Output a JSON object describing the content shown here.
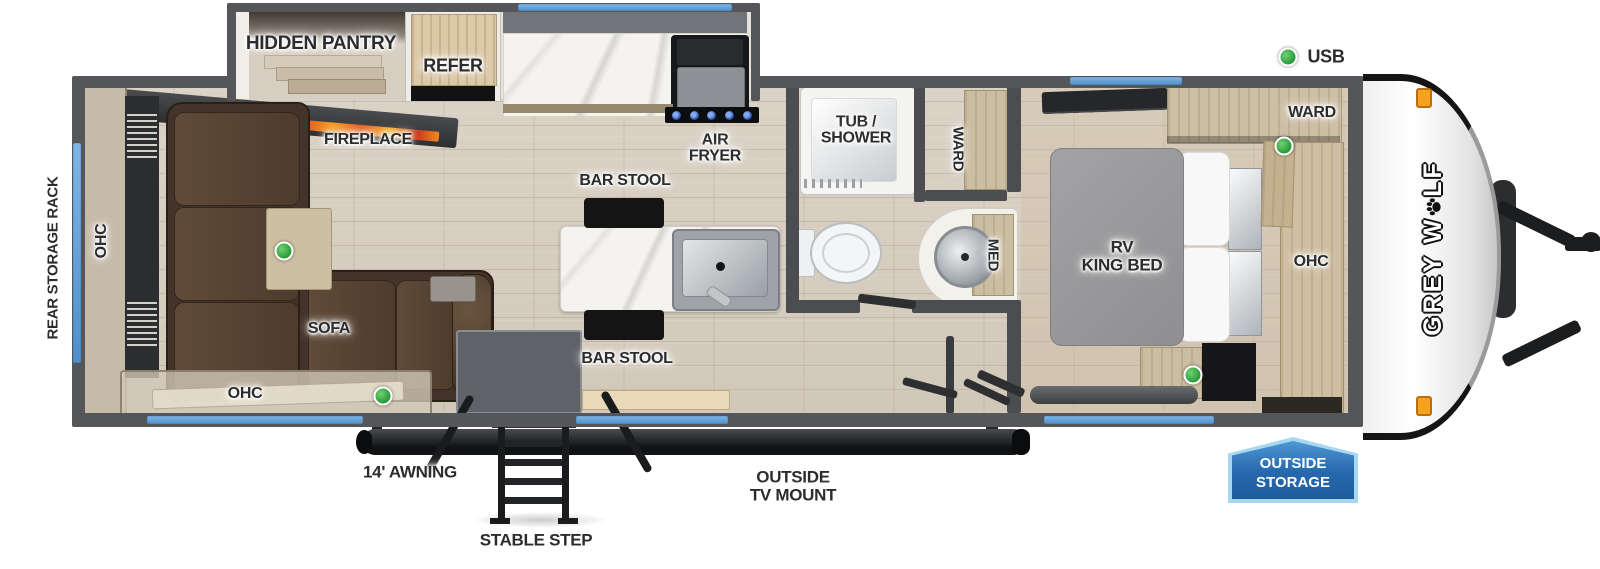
{
  "title": "Grey Wolf Travel Trailer Floorplan",
  "logo": {
    "prefix": "GREY W",
    "suffix": "LF"
  },
  "badge": {
    "line1": "OUTSIDE",
    "line2": "STORAGE"
  },
  "legend": {
    "usb_label": "USB"
  },
  "colors": {
    "wall": "#55565a",
    "window": "#62a0d8",
    "usb_green": "#3cb54a",
    "badge_blue": "#2f76b5",
    "marker_orange": "#f6a21d"
  },
  "labels": [
    {
      "name": "label-hidden-pantry",
      "text": "HIDDEN PANTRY",
      "x": 321,
      "y": 44,
      "size": 19,
      "rot": 0
    },
    {
      "name": "label-refer",
      "text": "REFER",
      "x": 453,
      "y": 66,
      "size": 18,
      "rot": 0
    },
    {
      "name": "label-fireplace",
      "text": "FIREPLACE",
      "x": 368,
      "y": 140,
      "size": 16,
      "rot": 0
    },
    {
      "name": "label-air-fryer",
      "text": "AIR\nFRYER",
      "x": 715,
      "y": 149,
      "size": 16,
      "rot": 0
    },
    {
      "name": "label-bar-stool-top",
      "text": "BAR STOOL",
      "x": 625,
      "y": 181,
      "size": 16,
      "rot": 0
    },
    {
      "name": "label-bar-stool-bottom",
      "text": "BAR STOOL",
      "x": 627,
      "y": 359,
      "size": 16,
      "rot": 0
    },
    {
      "name": "label-tub-shower",
      "text": "TUB /\nSHOWER",
      "x": 856,
      "y": 131,
      "size": 16,
      "rot": 0
    },
    {
      "name": "label-ward-bath",
      "text": "WARD",
      "x": 958,
      "y": 149,
      "size": 15,
      "rot": 90
    },
    {
      "name": "label-med",
      "text": "MED",
      "x": 993,
      "y": 255,
      "size": 15,
      "rot": 90
    },
    {
      "name": "label-rv-king-bed",
      "text": "RV\nKING BED",
      "x": 1122,
      "y": 256,
      "size": 17,
      "rot": 0
    },
    {
      "name": "label-ward-bedroom",
      "text": "WARD",
      "x": 1312,
      "y": 113,
      "size": 16,
      "rot": 0
    },
    {
      "name": "label-ohc-bedroom",
      "text": "OHC",
      "x": 1311,
      "y": 262,
      "size": 16,
      "rot": 0
    },
    {
      "name": "label-usb-legend",
      "text": "USB",
      "x": 1326,
      "y": 57,
      "size": 18,
      "rot": 0
    },
    {
      "name": "label-rear-storage-rack",
      "text": "REAR STORAGE RACK",
      "x": 53,
      "y": 258,
      "size": 15,
      "rot": -90
    },
    {
      "name": "label-ohc-left",
      "text": "OHC",
      "x": 102,
      "y": 241,
      "size": 16,
      "rot": -90
    },
    {
      "name": "label-ohc-bottom",
      "text": "OHC",
      "x": 245,
      "y": 394,
      "size": 16,
      "rot": 0
    },
    {
      "name": "label-sofa",
      "text": "SOFA",
      "x": 329,
      "y": 329,
      "size": 16,
      "rot": 0
    },
    {
      "name": "label-awning",
      "text": "14' AWNING",
      "x": 410,
      "y": 472,
      "size": 17,
      "rot": 0
    },
    {
      "name": "label-stable-step",
      "text": "STABLE STEP",
      "x": 536,
      "y": 540,
      "size": 17,
      "rot": 0
    },
    {
      "name": "label-outside-tv-mount",
      "text": "OUTSIDE\nTV MOUNT",
      "x": 793,
      "y": 486,
      "size": 17,
      "rot": 0
    }
  ],
  "usb_dots": [
    {
      "name": "usb-dot-legend",
      "x": 1288,
      "y": 57
    },
    {
      "name": "usb-dot-bedroom-ward",
      "x": 1284,
      "y": 146
    },
    {
      "name": "usb-dot-bedroom-nightstand",
      "x": 1193,
      "y": 375
    },
    {
      "name": "usb-dot-living-table",
      "x": 284,
      "y": 251
    },
    {
      "name": "usb-dot-living-ohc",
      "x": 383,
      "y": 396
    }
  ],
  "windows": [
    {
      "name": "window-slideout",
      "x": 518,
      "y": 4,
      "w": 214,
      "h": 7
    },
    {
      "name": "window-bedroom-top",
      "x": 1070,
      "y": 77,
      "w": 112,
      "h": 8
    },
    {
      "name": "window-rear",
      "x": 73,
      "y": 143,
      "w": 8,
      "h": 220
    },
    {
      "name": "window-bottom-left",
      "x": 147,
      "y": 416,
      "w": 216,
      "h": 8
    },
    {
      "name": "window-bottom-middle",
      "x": 576,
      "y": 416,
      "w": 152,
      "h": 8
    },
    {
      "name": "window-bedroom-bottom",
      "x": 1044,
      "y": 416,
      "w": 170,
      "h": 8
    }
  ]
}
